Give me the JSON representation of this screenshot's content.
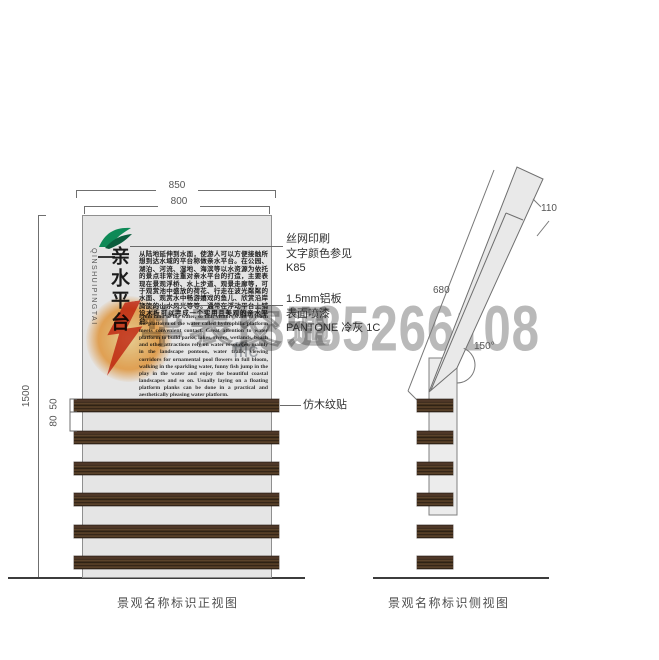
{
  "front_view": {
    "caption": "景观名称标识正视图",
    "dimensions": {
      "outer_width": "850",
      "panel_width": "800",
      "height": "1500",
      "slat_height": "50",
      "slat_gap": "80"
    },
    "sign": {
      "title": "亲水平台",
      "title_pinyin": "QINSHUIPINGTAI",
      "intro_cn": "从陆地延伸到水面，使游人可以方便接触所想到达水域的平台称做亲水平台。在公园、湖泊、河流、湿地、海滨等以水资源为依托的景点非常注重对亲水平台的打造，主要表现在景观浮桥、水上步道、观景走廊等，可于观赏池中盛放的荷花、行走在波光粼粼的水面、观赏水中畅游嬉戏的鱼儿、欣赏沿岸旖旎的山水风光等等。通常在浮动平台上铺设木板可以完成一个实用且美观的亲水平台。",
      "intro_en": "From land to the water, so that visitors want to reach the platform of the water called hydrophilic platform meets convenient contact. Great attention to water platform to build parks, lakes, rivers, wetlands, beach and other attractions rely on water resources, mainly in the landscape pontoon, water trails, viewing corridors for ornamental pool flowers in full bloom, walking in the sparkling water, funny fish jump in the play in the water and enjoy the beautiful coastal landscapes and so on. Usually laying on a floating platform planks can be done in a practical and aesthetically pleasing water platform."
    },
    "annotations": {
      "print": {
        "line1": "丝网印刷",
        "line2": "文字颜色参见",
        "line3": "K85"
      },
      "panel": {
        "line1": "1.5mm铝板",
        "line2": "表面喷漆",
        "line3": "PANTONE 冷灰 1C"
      },
      "wood": {
        "line1": "仿木纹贴"
      }
    }
  },
  "side_view": {
    "caption": "景观名称标识侧视图",
    "dimensions": {
      "top_offset": "110",
      "sign_length": "680",
      "tilt_angle": "150°"
    }
  },
  "watermark": {
    "phone": "13585266108",
    "brand": "华表交通",
    "partial": "ffic"
  },
  "colors": {
    "panel_gray": "#e5e5e5",
    "wood_brown": "#4a3424",
    "accent_green": "#0e8a57",
    "watermark_gray": "#b5b5b5",
    "glow_orange": "#f7941d",
    "bolt_red": "#d93a2b"
  }
}
